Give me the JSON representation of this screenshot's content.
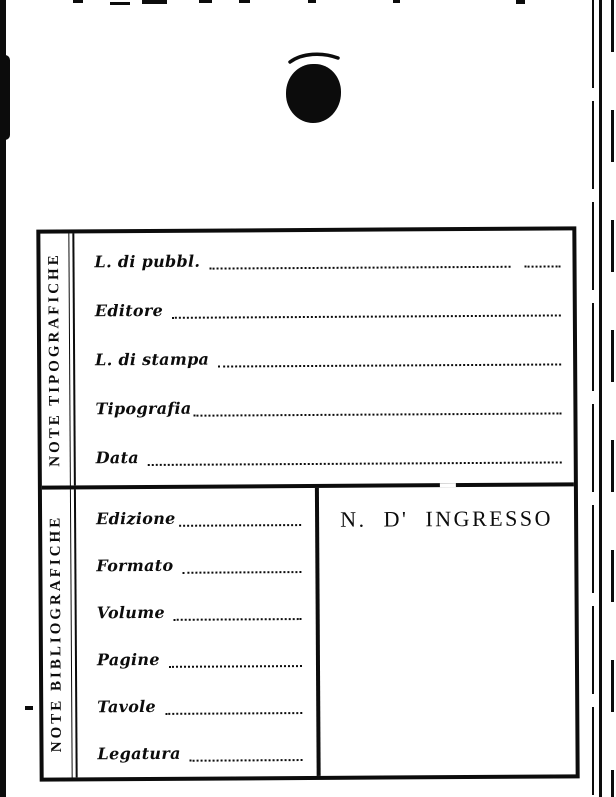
{
  "colors": {
    "paper": "#ffffff",
    "ink": "#0c0c0c"
  },
  "card": {
    "sections": [
      {
        "label": "NOTE TIPOGRAFICHE",
        "fields": [
          {
            "label": "L. di pubbl.",
            "value": ""
          },
          {
            "label": "Editore",
            "value": ""
          },
          {
            "label": "L. di stampa",
            "value": ""
          },
          {
            "label": "Tipografia",
            "value": ""
          },
          {
            "label": "Data",
            "value": ""
          }
        ]
      },
      {
        "label": "NOTE BIBLIOGRAFICHE",
        "fields": [
          {
            "label": "Edizione",
            "value": ""
          },
          {
            "label": "Formato",
            "value": ""
          },
          {
            "label": "Volume",
            "value": ""
          },
          {
            "label": "Pagine",
            "value": ""
          },
          {
            "label": "Tavole",
            "value": ""
          },
          {
            "label": "Legatura",
            "value": ""
          }
        ],
        "ingresso": {
          "label": "N. D' INGRESSO"
        }
      }
    ]
  }
}
